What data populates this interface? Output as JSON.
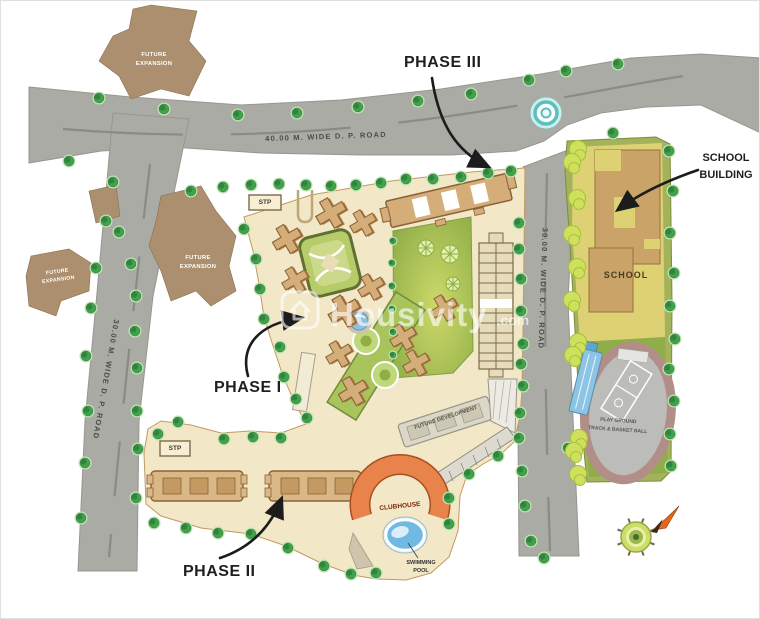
{
  "labels": {
    "phase1": "PHASE I",
    "phase2": "PHASE II",
    "phase3": "PHASE III",
    "school_building": "SCHOOL\nBUILDING",
    "school": "SCHOOL",
    "clubhouse": "CLUBHOUSE",
    "swimming_pool": "SWIMMING\nPOOL",
    "stp": "STP",
    "future_expansion": "FUTURE\nEXPANSION",
    "future_development": "FUTURE DEVELOPMENT",
    "playground": "PLAY GROUND\nTRACK & BASKET BALL"
  },
  "roads": {
    "top": "40.00 M. WIDE D. P. ROAD",
    "left": "30.00 M. WIDE D. P. ROAD",
    "right": "30.00 M. WIDE D. P. ROAD"
  },
  "watermark": {
    "brand": "Housivity",
    "suffix": ".com"
  },
  "colors": {
    "road_grey": "#ababa6",
    "site_beige": "#f2e7c6",
    "lawn_green": "#9cc04a",
    "building_tan": "#d4ad79",
    "future_expansion_brown": "#ab8f6e",
    "clubhouse_orange": "#e8834b",
    "pool_blue": "#6fb9e2",
    "track_ring": "#b28e88",
    "school_yellow": "#ded173",
    "tree_green": "#43a14c",
    "roundabout_teal": "#5bbfbf"
  }
}
